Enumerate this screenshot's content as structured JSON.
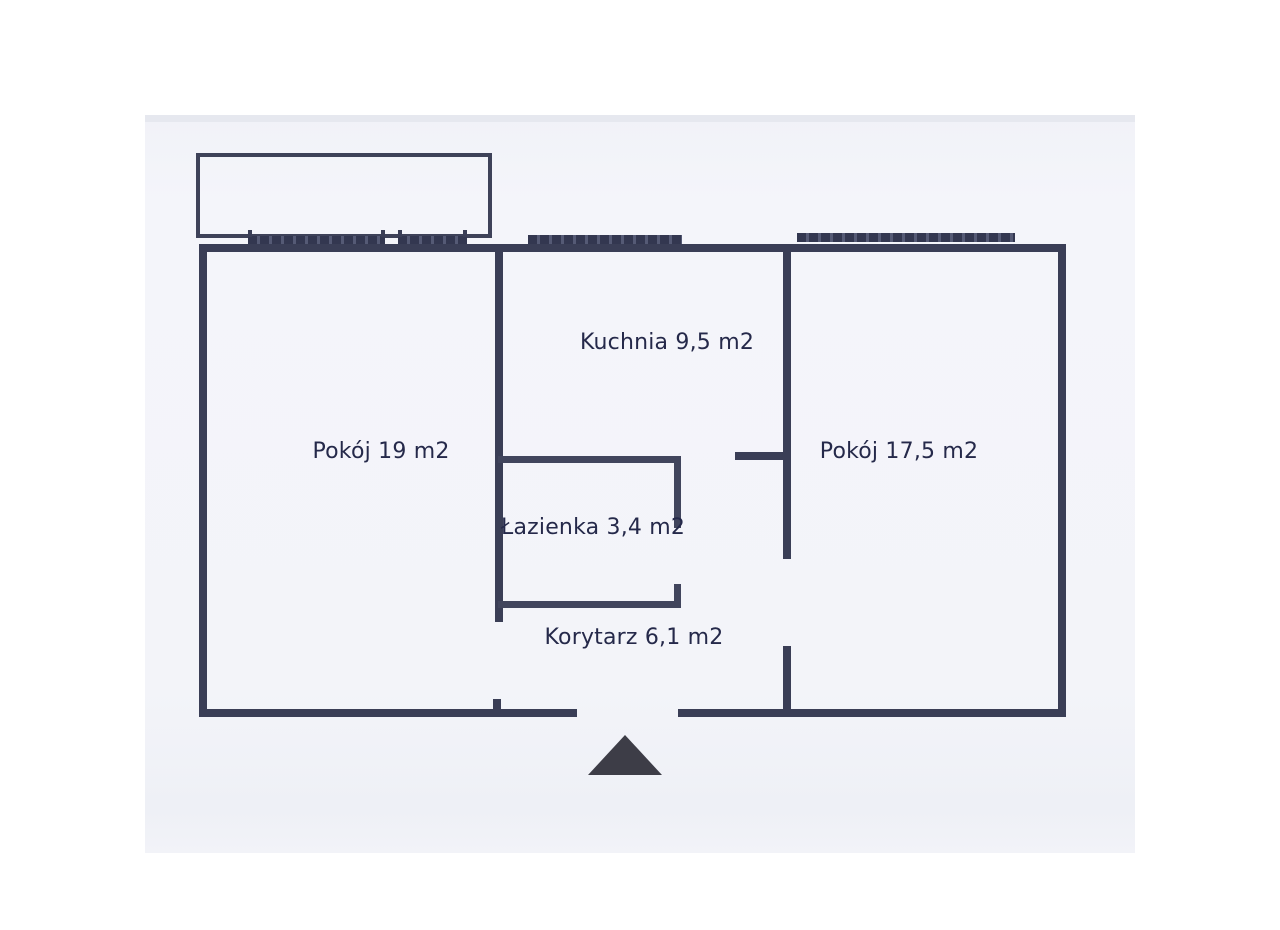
{
  "document": {
    "kind_label": "floor-plan-scan"
  },
  "colors": {
    "wall": "#3a3e56",
    "text": "#25294a",
    "entrance_arrow": "#3d3d47",
    "scan_background": "#f3f4f9",
    "page_background": "#ffffff"
  },
  "rooms": [
    {
      "id": "pokoj-19",
      "label": "Pokój 19 m2"
    },
    {
      "id": "kuchnia",
      "label": "Kuchnia 9,5 m2"
    },
    {
      "id": "pokoj-17-5",
      "label": "Pokój 17,5 m2"
    },
    {
      "id": "lazienka",
      "label": "Łazienka 3,4 m2"
    },
    {
      "id": "korytarz",
      "label": "Korytarz 6,1 m2"
    }
  ],
  "icons": {
    "entrance_arrow": "up-triangle"
  }
}
